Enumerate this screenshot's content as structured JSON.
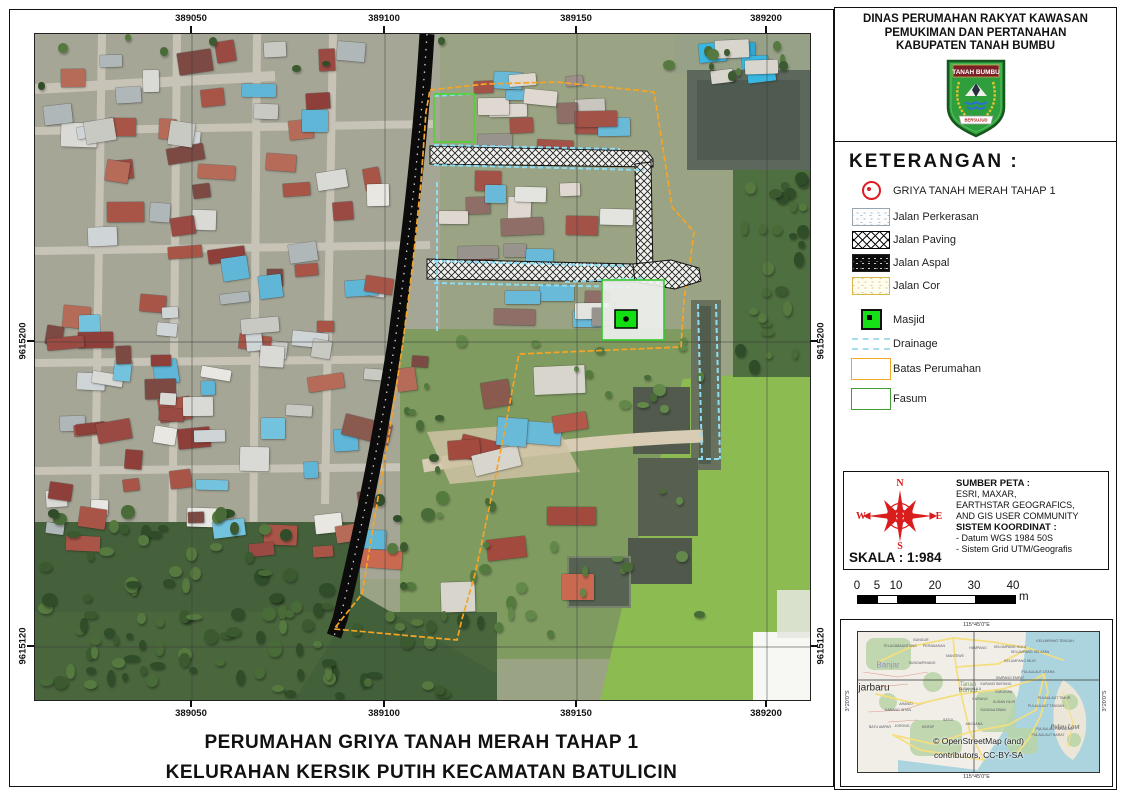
{
  "header": {
    "title_lines": [
      "DINAS PERUMAHAN RAKYAT KAWASAN",
      "PEMUKIMAN DAN PERTANAHAN",
      "KABUPATEN TANAH BUMBU"
    ],
    "logo": {
      "banner": "TANAH BUMBU",
      "motto": "BERSUJUD"
    }
  },
  "legend": {
    "title": "KETERANGAN :",
    "items": [
      {
        "label": "GRIYA TANAH MERAH TAHAP 1",
        "symbol": "red-point"
      },
      {
        "label": "Jalan Perkerasan",
        "symbol": "perkerasan"
      },
      {
        "label": "Jalan Paving",
        "symbol": "paving"
      },
      {
        "label": "Jalan Aspal",
        "symbol": "aspal"
      },
      {
        "label": "Jalan Cor",
        "symbol": "cor"
      },
      {
        "label": "Masjid",
        "symbol": "masjid"
      },
      {
        "label": "Drainage",
        "symbol": "drainage"
      },
      {
        "label": "Batas Perumahan",
        "symbol": "batas"
      },
      {
        "label": "Fasum",
        "symbol": "fasum"
      }
    ]
  },
  "info_box": {
    "compass_labels": {
      "n": "N",
      "e": "E",
      "s": "S",
      "w": "W"
    },
    "skala_label": "SKALA : 1:984",
    "sumber_title": "SUMBER PETA :",
    "sumber_lines": [
      "ESRI, MAXAR,",
      "EARTHSTAR GEOGRAFICS,",
      "AND GIS USER COMMUNITY"
    ],
    "koordinat_title": "SISTEM KOORDINAT :",
    "koordinat_lines": [
      "- Datum WGS 1984 50S",
      "- Sistem Grid UTM/Geografis"
    ]
  },
  "scalebar": {
    "ticks": [
      "0",
      "5",
      "10",
      "20",
      "30",
      "40"
    ],
    "unit": "m"
  },
  "map_frame": {
    "easting_labels": [
      "389050",
      "389100",
      "389150",
      "389200"
    ],
    "northing_labels": [
      "9615200",
      "9615120"
    ]
  },
  "title_block": {
    "lines": [
      "PERUMAHAN GRIYA TANAH MERAH TAHAP 1",
      "KELURAHAN KERSIK PUTIH KECAMATAN BATULICIN"
    ]
  },
  "inset": {
    "top_coord": "115°45'0\"E",
    "bottom_coord": "115°45'0\"E",
    "left_coord": "3°20'0\"S",
    "right_coord": "3°20'0\"S",
    "attribution_lines": [
      "© OpenStreetMap (and)",
      "contributors, CC-BY-SA"
    ],
    "labels": [
      {
        "t": "Banjar",
        "x": 30,
        "y": 33,
        "cls": "city"
      },
      {
        "t": "jarbaru",
        "x": 16,
        "y": 56,
        "cls": "city2"
      },
      {
        "t": "Tanah\nBumbu",
        "x": 110,
        "y": 56,
        "cls": "region"
      },
      {
        "t": "Pulau Laut",
        "x": 207,
        "y": 95,
        "cls": "island"
      },
      {
        "t": "BUNGUR",
        "x": 63,
        "y": 8,
        "cls": "minor"
      },
      {
        "t": "TELAGABAUNTUNG",
        "x": 42,
        "y": 14,
        "cls": "minor"
      },
      {
        "t": "PERAMASAN",
        "x": 76,
        "y": 14,
        "cls": "minor"
      },
      {
        "t": "SUNGAIPINANG",
        "x": 64,
        "y": 31,
        "cls": "minor"
      },
      {
        "t": "MANTEWE",
        "x": 97,
        "y": 24,
        "cls": "minor"
      },
      {
        "t": "HAMPANG",
        "x": 120,
        "y": 16,
        "cls": "minor"
      },
      {
        "t": "KELUMPANG TENGAH",
        "x": 197,
        "y": 9,
        "cls": "minor"
      },
      {
        "t": "KELUMPANG HULU",
        "x": 152,
        "y": 15,
        "cls": "minor"
      },
      {
        "t": "KELUMPANG SELATAN",
        "x": 172,
        "y": 20,
        "cls": "minor"
      },
      {
        "t": "KELUMPANG HILIR",
        "x": 162,
        "y": 29,
        "cls": "minor"
      },
      {
        "t": "PULAULAUT UTARA",
        "x": 180,
        "y": 40,
        "cls": "minor"
      },
      {
        "t": "SIMPANG EMPAT",
        "x": 152,
        "y": 46,
        "cls": "minor"
      },
      {
        "t": "KARANG BINTANG",
        "x": 138,
        "y": 52,
        "cls": "minor"
      },
      {
        "t": "KUSAN HULU",
        "x": 112,
        "y": 57,
        "cls": "minor"
      },
      {
        "t": "KUKUSAN",
        "x": 146,
        "y": 60,
        "cls": "minor"
      },
      {
        "t": "KURANJI",
        "x": 122,
        "y": 67,
        "cls": "minor"
      },
      {
        "t": "KUSAN HILIR",
        "x": 146,
        "y": 70,
        "cls": "minor"
      },
      {
        "t": "PULAULAUT TIMUR",
        "x": 196,
        "y": 66,
        "cls": "minor"
      },
      {
        "t": "PULAULAUT TENGAH",
        "x": 188,
        "y": 74,
        "cls": "minor"
      },
      {
        "t": "SUNGAILOBAN",
        "x": 135,
        "y": 78,
        "cls": "minor"
      },
      {
        "t": "SATUI",
        "x": 90,
        "y": 88,
        "cls": "minor"
      },
      {
        "t": "ANGSANA",
        "x": 116,
        "y": 92,
        "cls": "minor"
      },
      {
        "t": "ARANIO",
        "x": 48,
        "y": 72,
        "cls": "minor"
      },
      {
        "t": "KARANG INTAN",
        "x": 40,
        "y": 78,
        "cls": "minor"
      },
      {
        "t": "BATU AMPAR",
        "x": 22,
        "y": 95,
        "cls": "minor"
      },
      {
        "t": "JORONG",
        "x": 44,
        "y": 94,
        "cls": "minor"
      },
      {
        "t": "KINTAP",
        "x": 70,
        "y": 95,
        "cls": "minor"
      },
      {
        "t": "PULAULAUT SELATAN",
        "x": 196,
        "y": 97,
        "cls": "minor"
      },
      {
        "t": "PULAULAUT BARAT",
        "x": 190,
        "y": 103,
        "cls": "minor"
      }
    ]
  },
  "colors": {
    "boundary_orange": "#f6a426",
    "fasum_green": "#3fae2f",
    "masjid_green": "#12df12",
    "drainage_cyan": "#8fdcf0",
    "compass_red": "#d91c1c",
    "legend_point_red": "#e01b24",
    "asphalt_black": "#0b0b0b"
  }
}
